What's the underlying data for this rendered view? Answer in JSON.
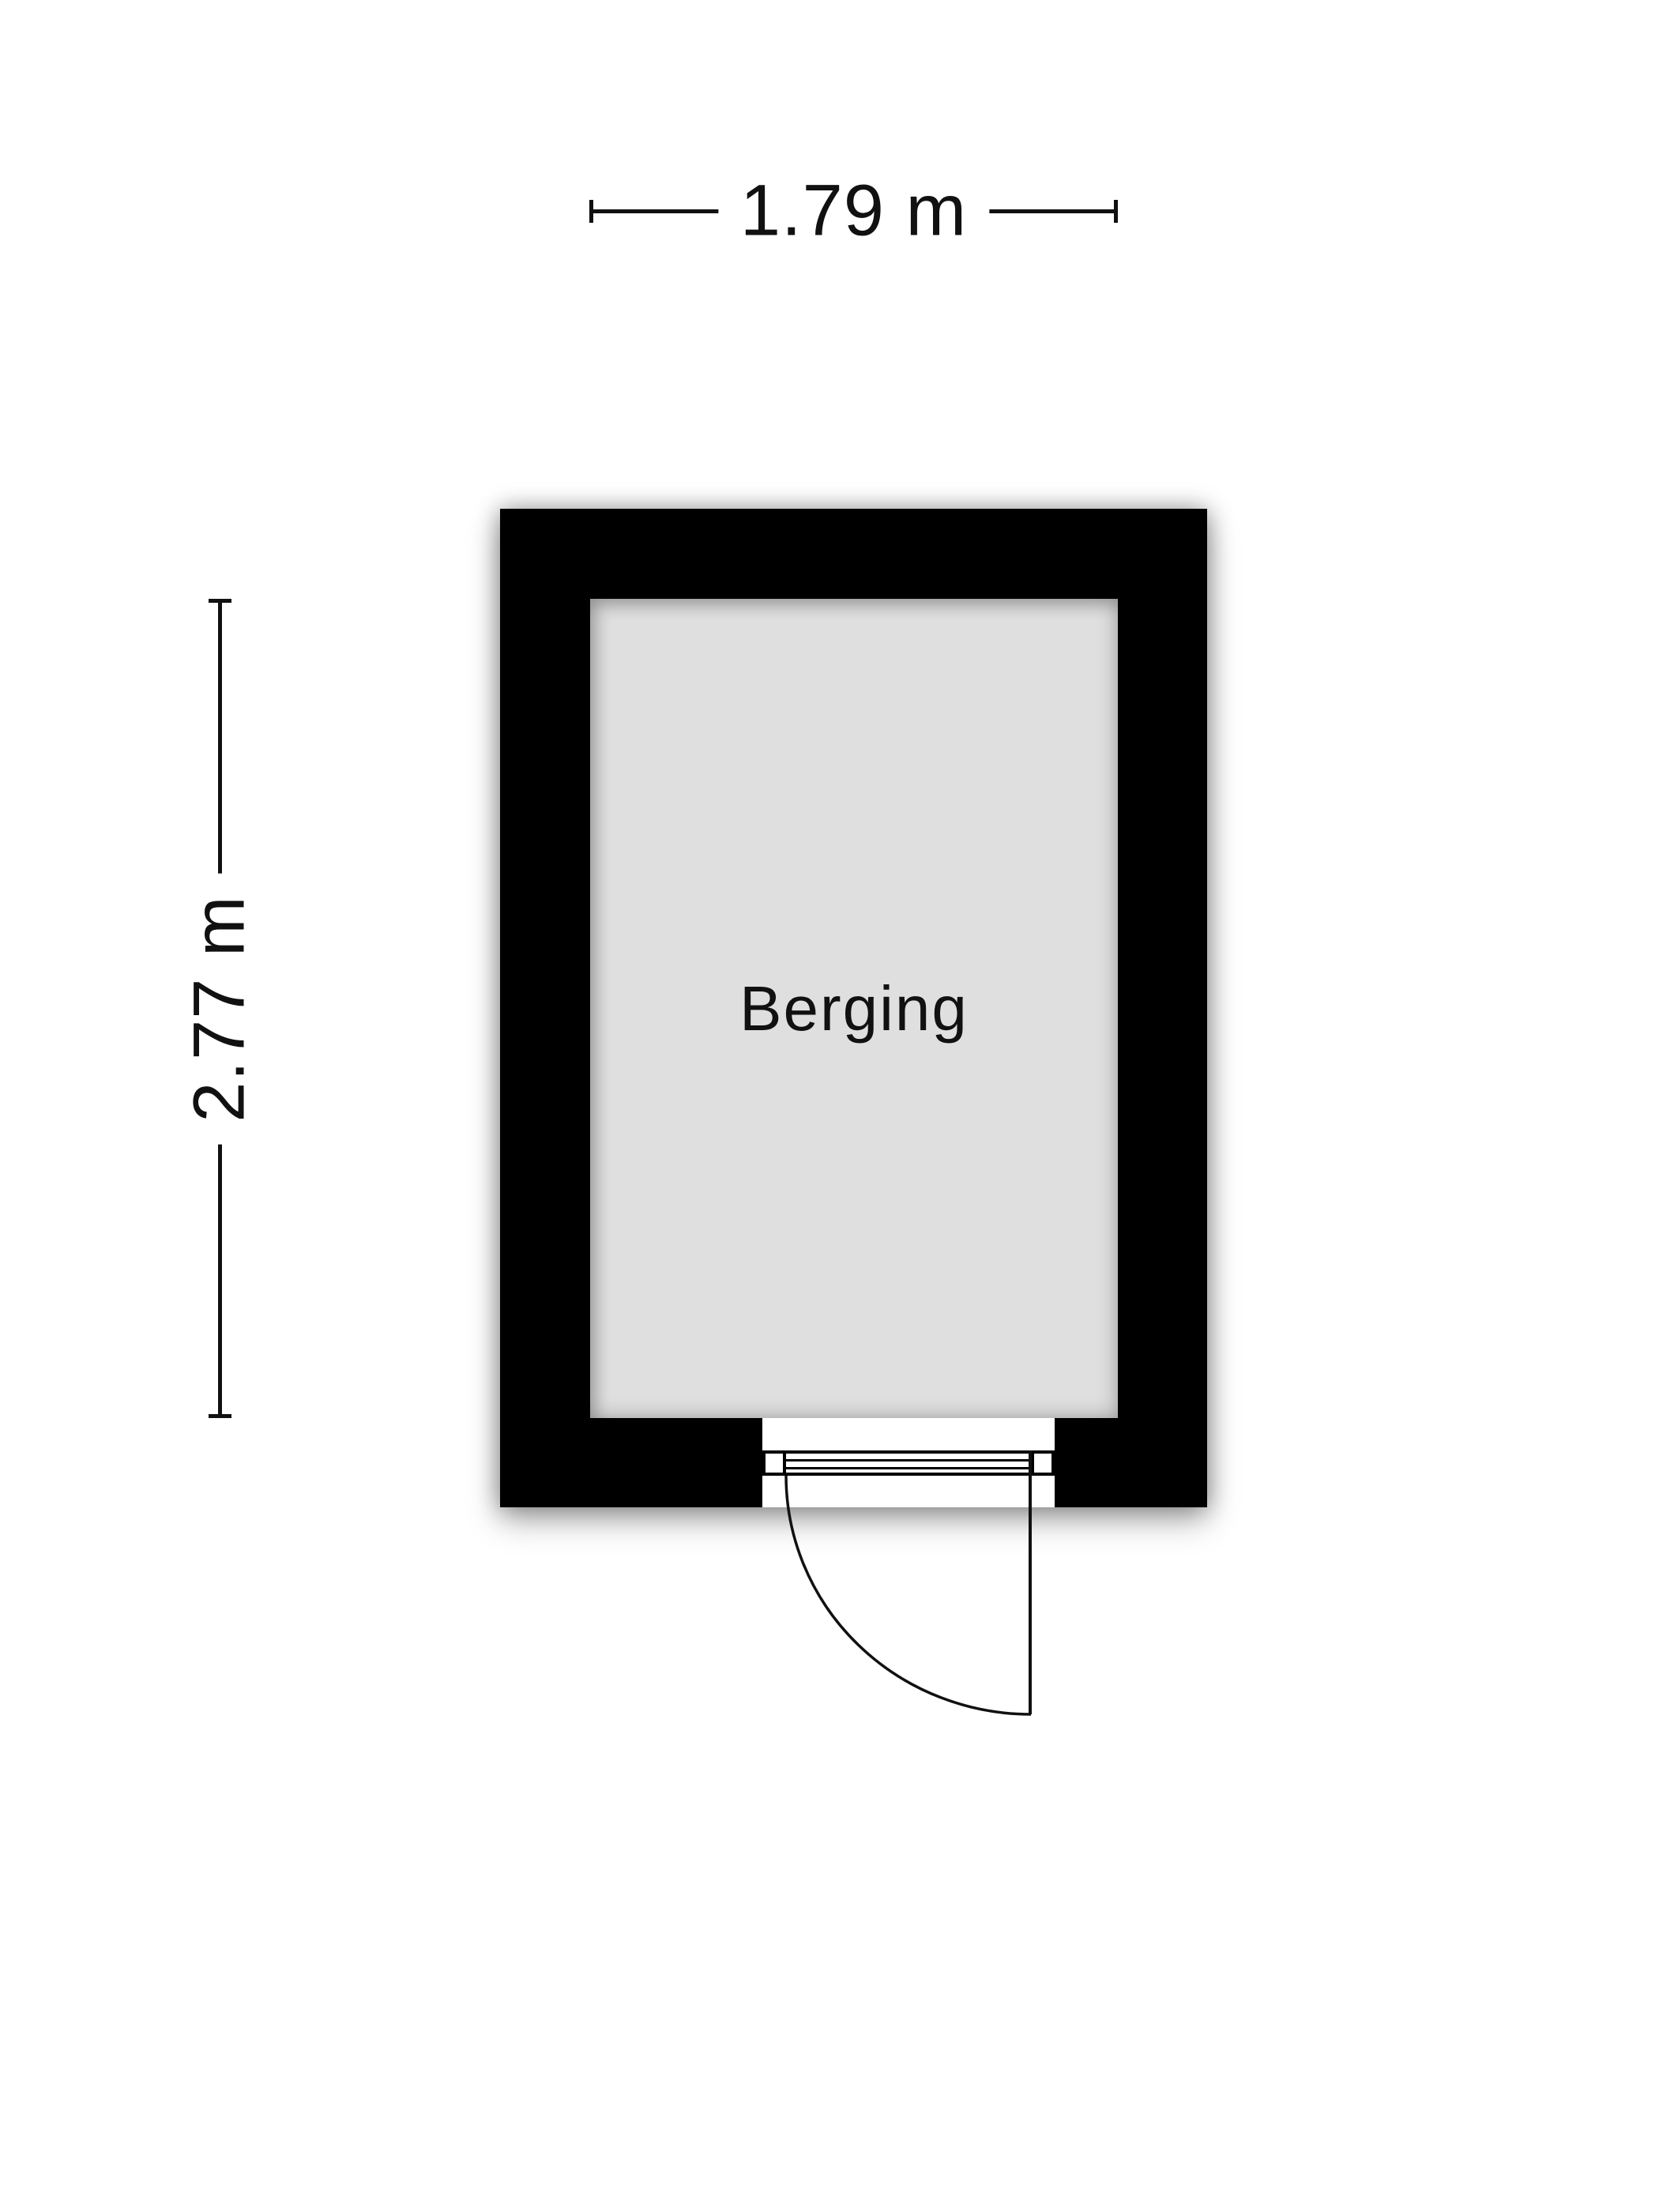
{
  "floorplan": {
    "room": {
      "label": "Berging"
    },
    "dimensions": {
      "width": {
        "label": "1.79 m"
      },
      "height": {
        "label": "2.77 m"
      }
    }
  },
  "colors": {
    "wall": "#000000",
    "room_fill": "#dfdfdf",
    "line": "#111111",
    "text": "#111111",
    "background": "#ffffff"
  }
}
